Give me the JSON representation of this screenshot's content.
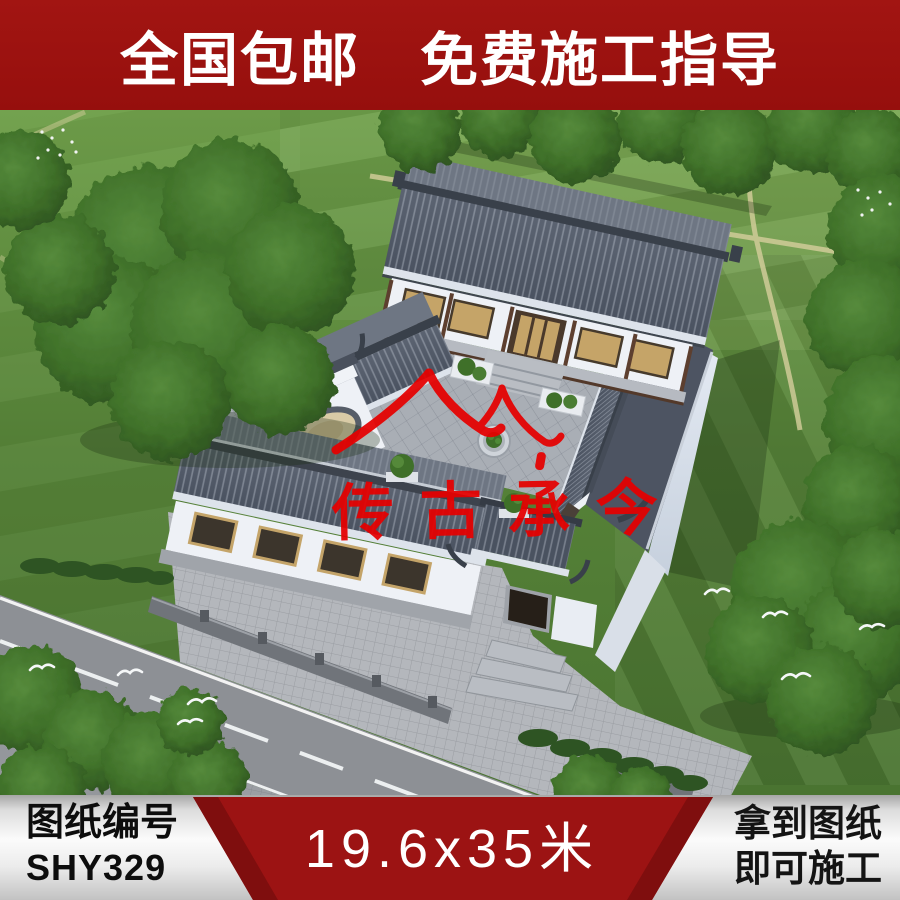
{
  "top_banner": {
    "text": "全国包邮　免费施工指导",
    "bg_color": "#9b1210",
    "text_color": "#ffffff"
  },
  "photo": {
    "watermark": {
      "brand_text": "传古承今",
      "color": "#e60000",
      "logo": "double-roof-icon"
    }
  },
  "bottom_banner": {
    "left_panel": {
      "label": "图纸编号",
      "drawing_code": "SHY329"
    },
    "middle_panel": {
      "dimensions_text": "19.6x35米",
      "bg_color": "#9c1313",
      "text_color": "#ffffff"
    },
    "right_panel": {
      "line1": "拿到图纸",
      "line2": "即可施工"
    }
  }
}
